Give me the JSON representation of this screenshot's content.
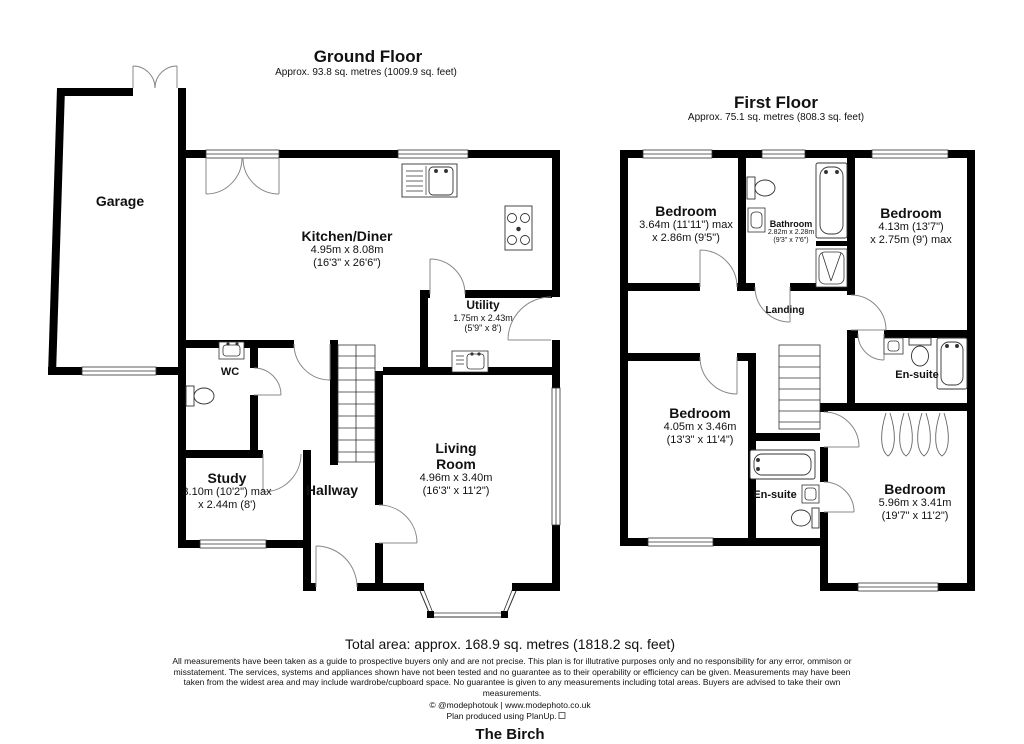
{
  "ground_floor": {
    "title": "Ground Floor",
    "subtitle": "Approx. 93.8 sq. metres (1009.9 sq. feet)",
    "rooms": {
      "garage": {
        "name": "Garage"
      },
      "kitchen_diner": {
        "name": "Kitchen/Diner",
        "size_m": "4.95m x 8.08m",
        "size_ft": "(16'3\" x 26'6\")"
      },
      "utility": {
        "name": "Utility",
        "size_m": "1.75m x 2.43m",
        "size_ft": "(5'9\" x 8')"
      },
      "wc": {
        "name": "WC"
      },
      "study": {
        "name": "Study",
        "size_m": "3.10m (10'2\") max",
        "size_ft": "x 2.44m (8')"
      },
      "hallway": {
        "name": "Hallway"
      },
      "living_room": {
        "name_line1": "Living",
        "name_line2": "Room",
        "size_m": "4.96m x 3.40m",
        "size_ft": "(16'3\" x 11'2\")"
      }
    }
  },
  "first_floor": {
    "title": "First Floor",
    "subtitle": "Approx. 75.1 sq. metres (808.3 sq. feet)",
    "rooms": {
      "bedroom_top_left": {
        "name": "Bedroom",
        "size_m": "3.64m (11'11\") max",
        "size_ft": "x 2.86m (9'5\")"
      },
      "bathroom": {
        "name": "Bathroom",
        "size_m": "2.82m x 2.28m",
        "size_ft": "(9'3\" x 7'6\")"
      },
      "bedroom_top_right": {
        "name": "Bedroom",
        "size_m": "4.13m (13'7\")",
        "size_ft": "x 2.75m (9') max"
      },
      "landing": {
        "name": "Landing"
      },
      "ensuite_right": {
        "name": "En-suite"
      },
      "bedroom_bottom_left": {
        "name": "Bedroom",
        "size_m": "4.05m x 3.46m",
        "size_ft": "(13'3\" x 11'4\")"
      },
      "ensuite_bottom": {
        "name": "En-suite"
      },
      "bedroom_bottom_right": {
        "name": "Bedroom",
        "size_m": "5.96m x 3.41m",
        "size_ft": "(19'7\" x 11'2\")"
      }
    }
  },
  "footer": {
    "total_area": "Total area: approx. 168.9 sq. metres (1818.2 sq. feet)",
    "disclaimer": "All measurements have been taken as a guide to prospective buyers only and are not precise. This plan is for illutrative purposes only and no responsibility for any error, ommison or misstatement. The services, systems and appliances shown have not been tested and no guarantee as to their operability or efficiency can be given. Measurements may have been taken from the widest area and may include wardrobe/cupboard space. No guarantee is given to any measurements including total areas. Buyers are advised to take their own measurements.",
    "credit": "© @modephotouk | www.modephoto.co.uk",
    "produced_by": "Plan produced using PlanUp.",
    "property_name": "The Birch"
  }
}
